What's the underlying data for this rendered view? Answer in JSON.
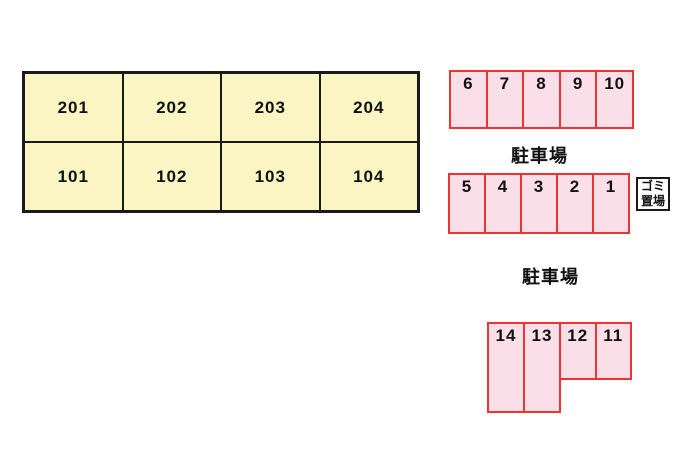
{
  "colors": {
    "room_fill": "#faf5c2",
    "room_border": "#1a1a1a",
    "parking_fill": "#fbdfe8",
    "parking_border": "#ee3333",
    "text": "#111111"
  },
  "building": {
    "floors": [
      {
        "rooms": [
          "201",
          "202",
          "203",
          "204"
        ]
      },
      {
        "rooms": [
          "101",
          "102",
          "103",
          "104"
        ]
      }
    ]
  },
  "parking": {
    "area1": {
      "label": "駐車場",
      "row_north": [
        "6",
        "7",
        "8",
        "9",
        "10"
      ],
      "row_south": [
        "5",
        "4",
        "3",
        "2",
        "1"
      ]
    },
    "area2": {
      "label": "駐車場",
      "tall_spaces": [
        "14",
        "13"
      ],
      "short_spaces": [
        "12",
        "11"
      ]
    }
  },
  "garbage": {
    "line1": "ゴミ",
    "line2": "置場"
  }
}
